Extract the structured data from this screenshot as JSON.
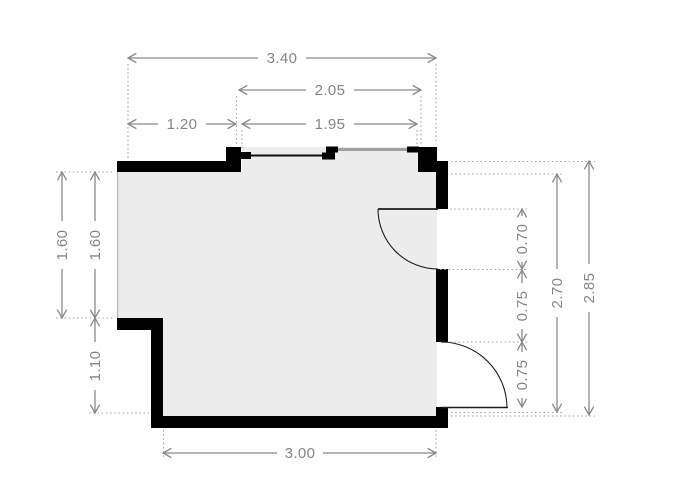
{
  "plan": {
    "name": "room-floor-plan",
    "colors": {
      "background": "#ffffff",
      "wall": "#000000",
      "floor": "#ececec",
      "dimension_line": "#8a8a8a",
      "dimension_text": "#858585",
      "extension_line": "#a5a5a5",
      "sliding_panel_gray": "#9e9e9e",
      "door_line": "#1c1c1c"
    },
    "doors": [
      {
        "name": "sliding-door-top",
        "type": "sliding",
        "width_label": "1.95"
      },
      {
        "name": "door-upper-right",
        "type": "swing-inward",
        "width_label": "0.70"
      },
      {
        "name": "door-lower-right",
        "type": "swing-outward",
        "width_label": "0.75"
      }
    ]
  },
  "dimensions": {
    "top": [
      {
        "name": "overall-width",
        "label": "3.40"
      },
      {
        "name": "opening-structural-width",
        "label": "2.05"
      },
      {
        "name": "top-left-wall-segment",
        "label": "1.20"
      },
      {
        "name": "sliding-door-width",
        "label": "1.95"
      }
    ],
    "left": [
      {
        "name": "upper-height-outer",
        "label": "1.60"
      },
      {
        "name": "upper-height-inner",
        "label": "1.60"
      },
      {
        "name": "lower-height",
        "label": "1.10"
      }
    ],
    "right": [
      {
        "name": "upper-door-opening",
        "label": "0.70"
      },
      {
        "name": "wall-between-doors",
        "label": "0.75"
      },
      {
        "name": "lower-door-opening",
        "label": "0.75"
      },
      {
        "name": "inner-height",
        "label": "2.70"
      },
      {
        "name": "overall-height",
        "label": "2.85"
      }
    ],
    "bottom": [
      {
        "name": "bottom-inner-width",
        "label": "3.00"
      }
    ]
  }
}
